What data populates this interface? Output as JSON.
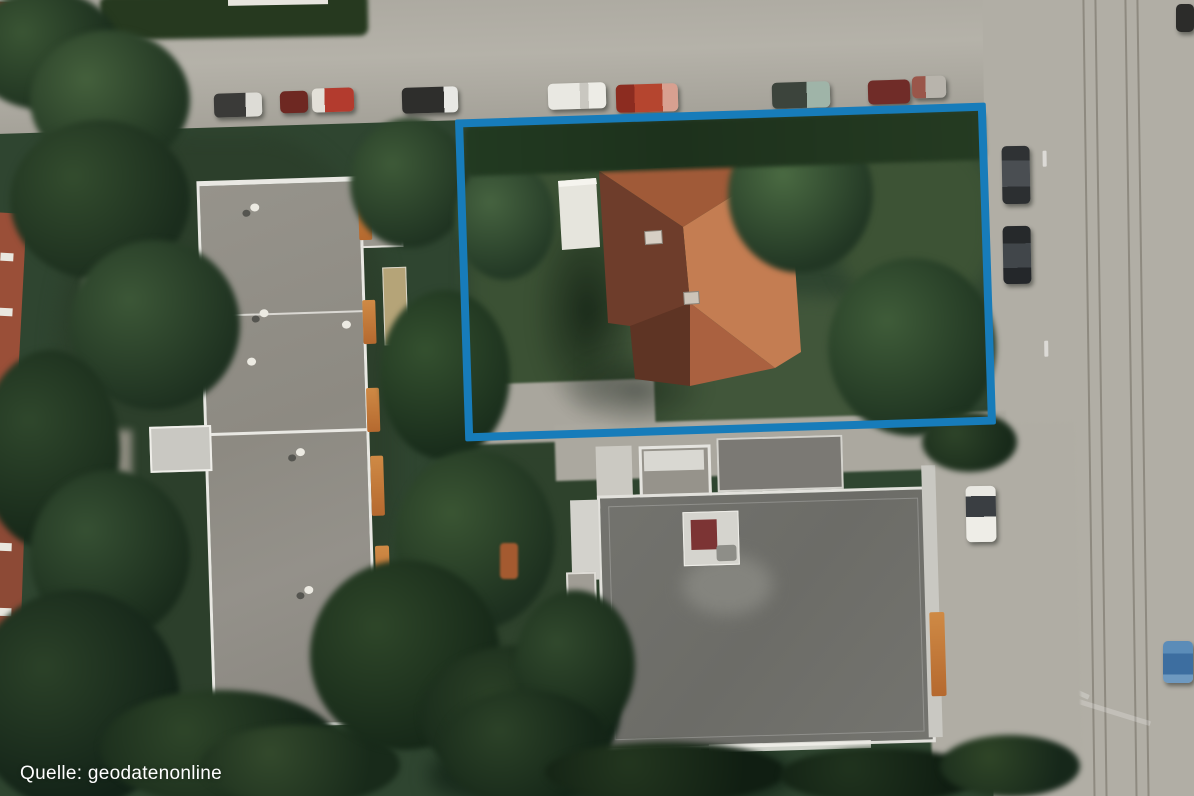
{
  "caption": {
    "text": "Quelle: geodatenonline"
  },
  "highlight": {
    "stroke_color": "#177cba",
    "shape": "rectangle-outline"
  }
}
